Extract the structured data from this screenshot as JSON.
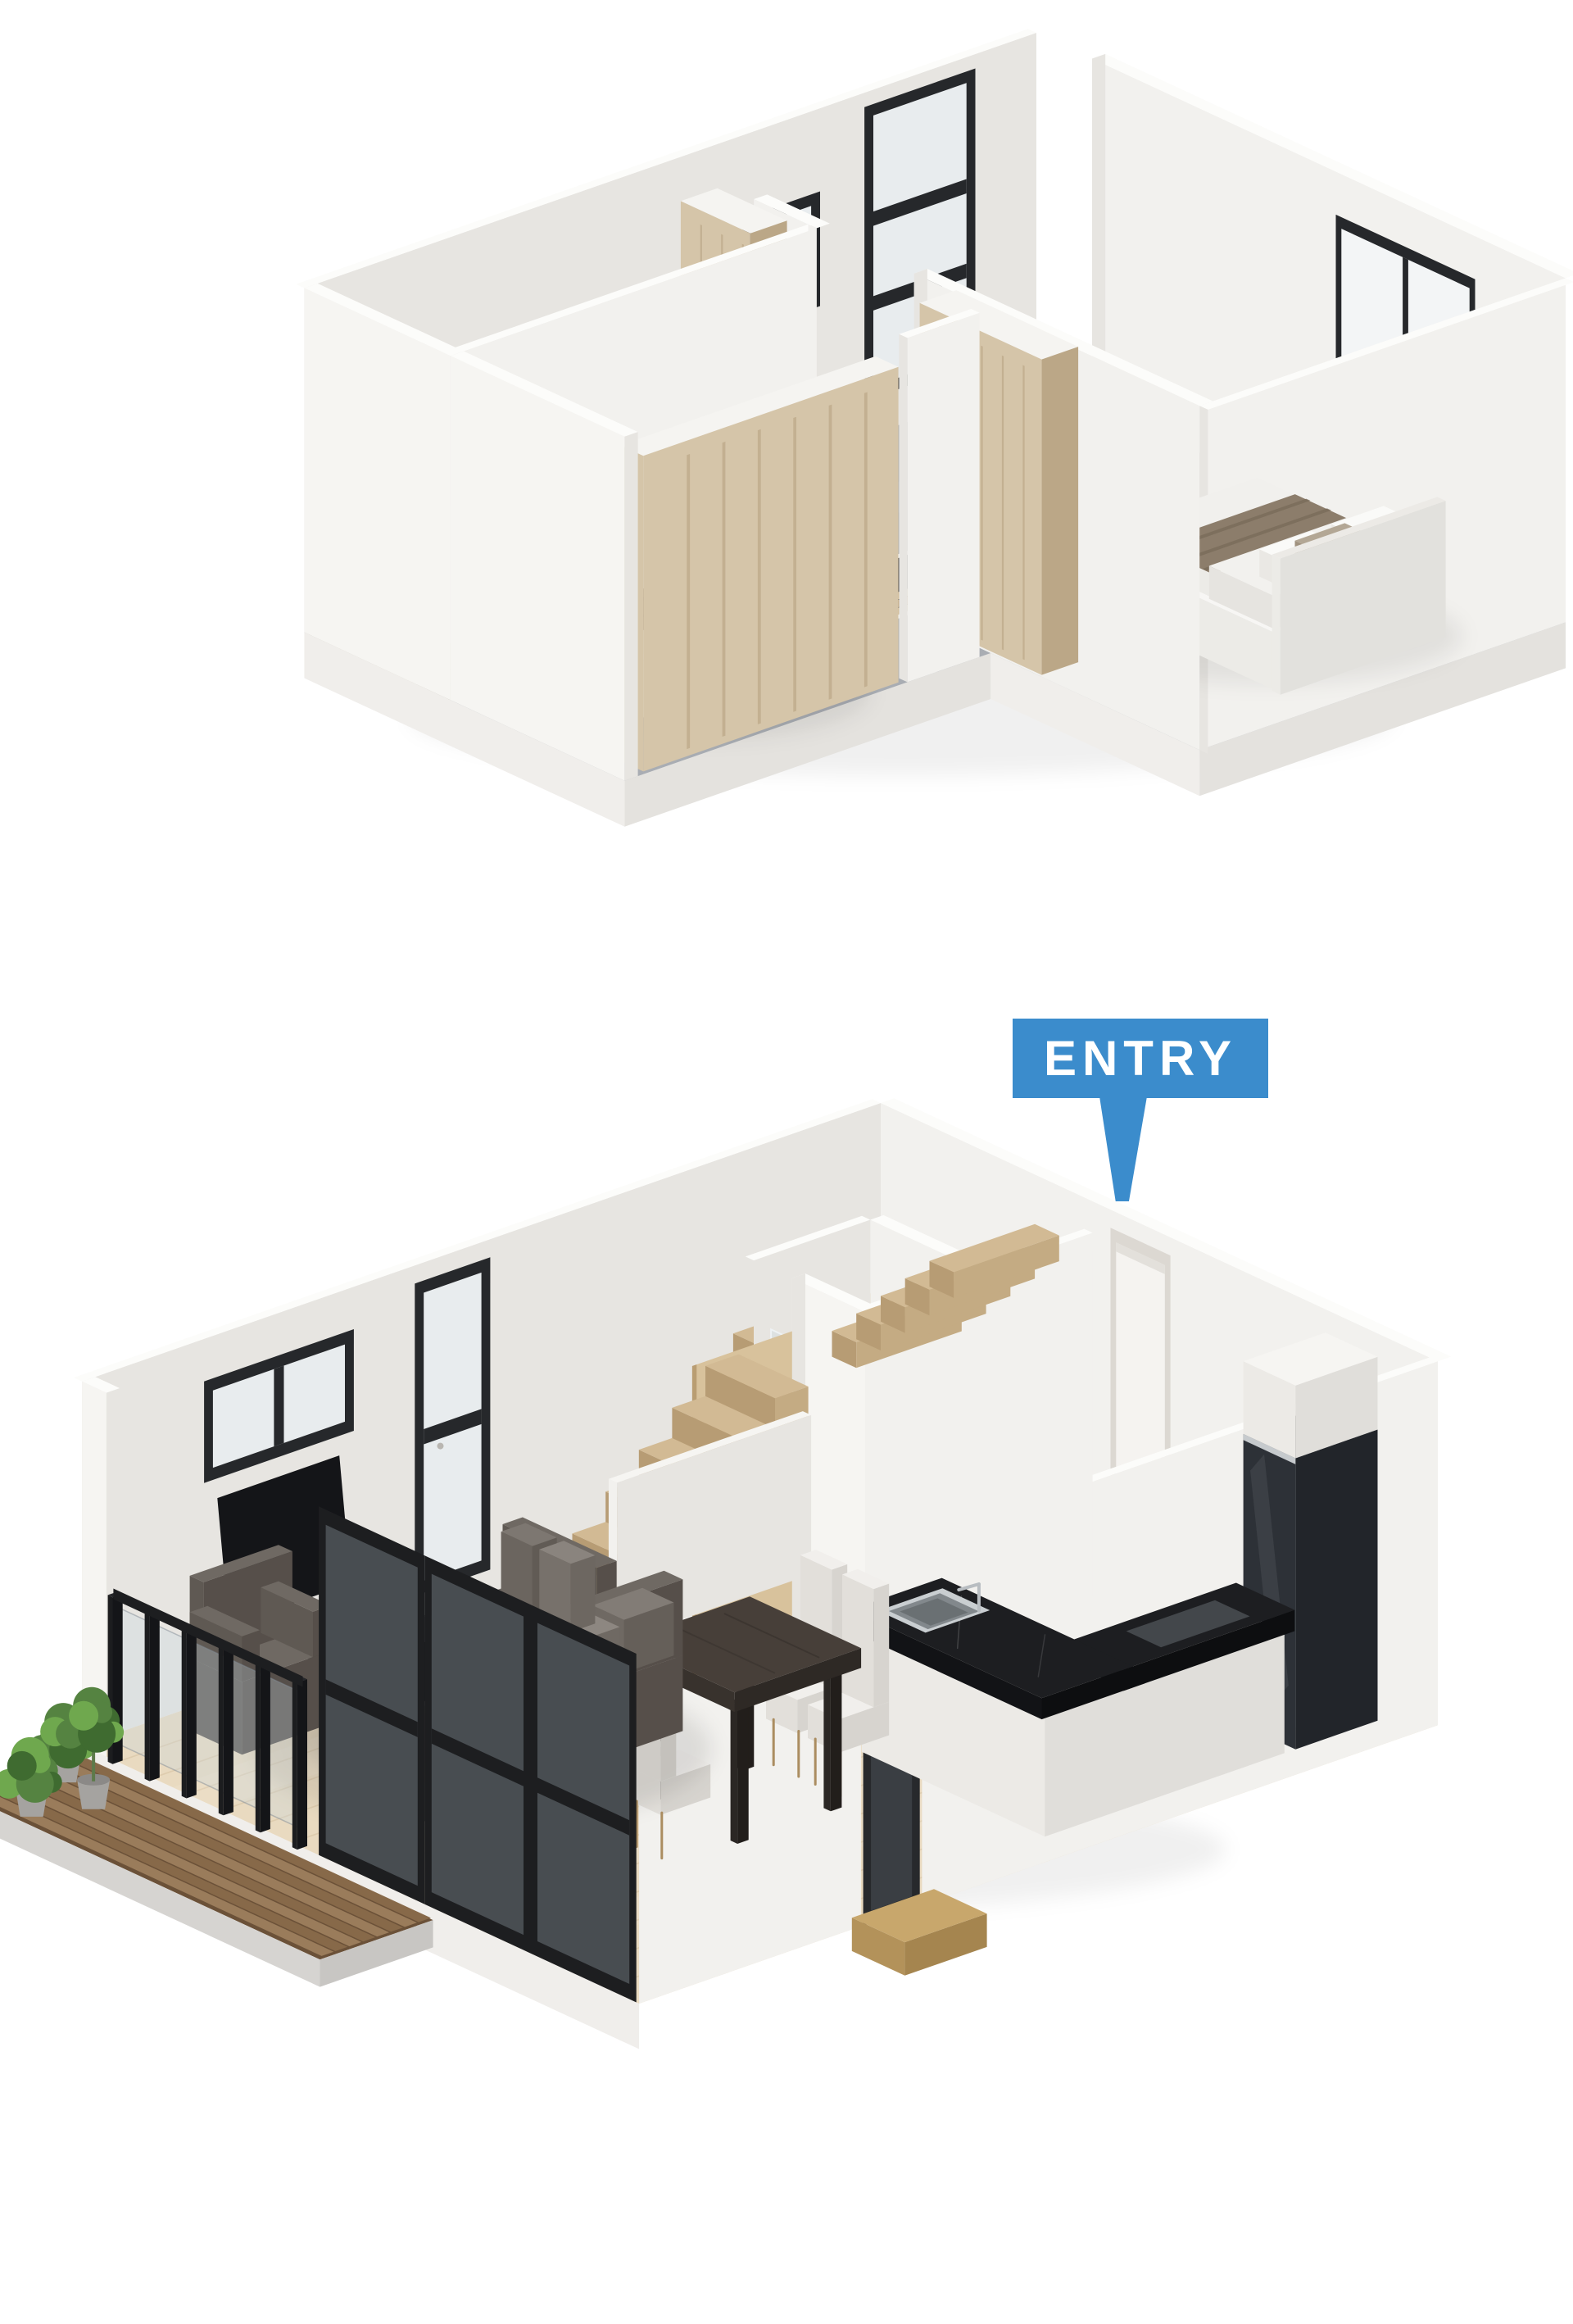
{
  "page": {
    "background": "#ffffff",
    "kind": "3d-floor-plan-render",
    "storeys": 2
  },
  "entry_label": {
    "text": "ENTRY",
    "bg": "#3b8ccc",
    "color": "#ffffff"
  },
  "palette": {
    "wall_light": "#f2f1ee",
    "wall_mid": "#e7e5e1",
    "wall_front": "#f6f5f2",
    "wall_top": "#fcfcfa",
    "slab_edge": "#f0eeeb",
    "slab_edge2": "#e4e2de",
    "floor_base": "#efece6",
    "carpet": "#a9adb3",
    "tile": "#dcd5c7",
    "tile_grout": "#c7bdac",
    "wood_floor": "#e9dac0",
    "wood_plank": "#d3bd9b",
    "stair_top": "#d2ba94",
    "stair_riser": "#b79c74",
    "stair_side": "#c4ab83",
    "deck_a": "#9a7c5b",
    "deck_b": "#876949",
    "deck_base": "#6b5138",
    "deck_fascia": "#d6d4d1",
    "deck_fascia2": "#c8c6c3",
    "wardrobe_wood": "#d5c5a9",
    "wardrobe_dark": "#bba787",
    "door_wood": "#d8c29c",
    "counter": "#1d1e21",
    "counter_side": "#121316",
    "counter_side2": "#0d0e10",
    "cabinet": "#eceae6",
    "cabinet_shade": "#e0deda",
    "fridge": "#2d3137",
    "fridge_side": "#22252a",
    "fridge_top": "#40454b",
    "steel": "#c9ced1",
    "steel_dark": "#82888c",
    "sofa_top": "#6f6963",
    "sofa_front": "#5f5953",
    "sofa_side": "#564f4a",
    "table_top": "#473f39",
    "table_side": "#38322d",
    "table_side2": "#2e2925",
    "chair": "#f1efec",
    "chair_shade": "#e2dfda",
    "chair_shade2": "#d7d4cf",
    "chair_leg": "#ab8d60",
    "black_metal": "#1d1e20",
    "glass": "rgba(200,214,226,0.30)",
    "glass2": "rgba(186,200,212,0.28)",
    "window_frame": "#26282b",
    "window_glass": "#f3f5f6",
    "window_glass_shade": "#e8ecee",
    "tv": "#141518",
    "fixture": "#fbfbfa",
    "fixture_shade": "#ecebe7",
    "fixture_shade2": "#e2e1dd",
    "mattress": "#f1f0ed",
    "bed_white": "#f7f6f4",
    "bed_runner": "#8c7d6b",
    "bed_runner_dark": "#796b5a",
    "headboard": "#eceae6",
    "plant_dark": "#3f6b30",
    "plant_mid": "#558341",
    "plant_light": "#6fa84e",
    "pot": "#a5a3a0",
    "pot_dark": "#8b8987",
    "shadow": "rgba(0,0,0,0.07)"
  },
  "floors": [
    {
      "id": "upper-floor",
      "rooms": [
        "bedroom-1",
        "bedroom-2",
        "bathroom",
        "hall",
        "stairwell"
      ],
      "furniture": [
        "double-bed-1",
        "double-bed-2",
        "wardrobe-1",
        "wardrobe-2",
        "hall-closet",
        "vanity-sink",
        "bathtub",
        "bathroom-door"
      ],
      "windows": [
        "tall-3-pane-window",
        "small-square-window",
        "wide-2-pane-window"
      ]
    },
    {
      "id": "ground-floor",
      "rooms": [
        "living-room",
        "dining-area",
        "kitchen",
        "shower-room",
        "entry",
        "deck"
      ],
      "furniture": [
        "corner-sofa",
        "armchair",
        "coffee-table",
        "dining-table",
        "dining-chairs",
        "kitchen-counter",
        "kitchen-sink",
        "fridge",
        "toilet",
        "shower",
        "staircase",
        "potted-plants",
        "entry-step",
        "wall-tv"
      ],
      "windows": [
        "tall-2-pane-window",
        "horizontal-2-pane-window",
        "sliding-glass-doors",
        "entry-door"
      ]
    }
  ]
}
